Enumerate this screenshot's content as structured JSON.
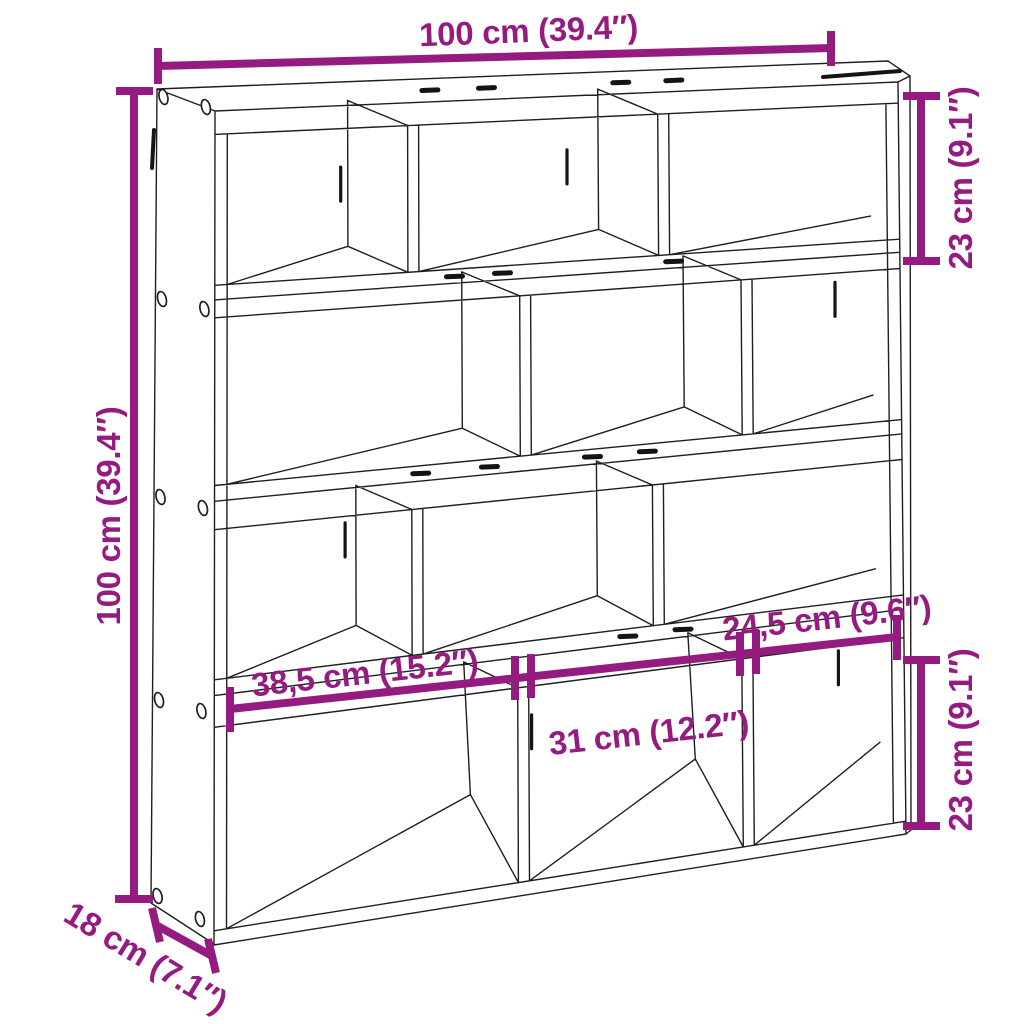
{
  "diagram": {
    "type": "product-dimension-diagram",
    "product": "Wall cube shelf with 12 compartments",
    "colors": {
      "dimension": "#951B81",
      "outline": "#1F1F1F",
      "background": "#FFFFFF"
    },
    "labels": {
      "overall_width": "100 cm (39.4″)",
      "overall_height": "100 cm (39.4″)",
      "depth": "18 cm (7.1″)",
      "top_cube_height": "23 cm (9.1″)",
      "bottom_cube_height": "23 cm (9.1″)",
      "compartment_left_width": "38,5 cm (15.2″)",
      "compartment_middle_width": "31 cm (12.2″)",
      "compartment_right_width": "24,5 cm (9.6″)"
    }
  }
}
